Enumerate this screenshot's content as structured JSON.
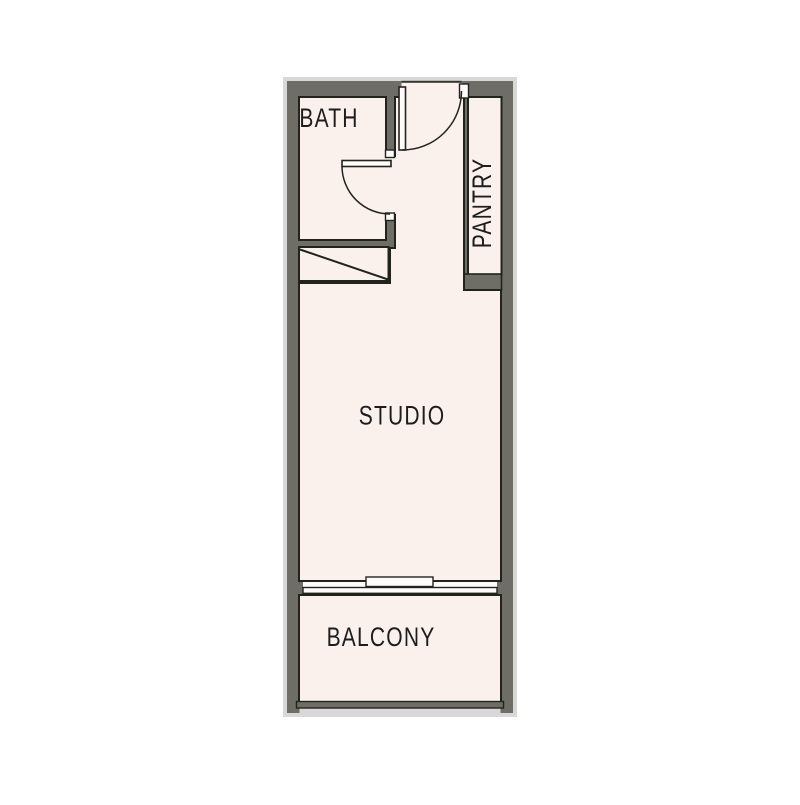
{
  "title": "Studio apartment floor plan",
  "rooms": {
    "bath": {
      "label": "BATH"
    },
    "pantry": {
      "label": "PANTRY"
    },
    "studio": {
      "label": "STUDIO"
    },
    "balcony": {
      "label": "BALCONY"
    }
  },
  "colors": {
    "wall": "#6e6e66",
    "floor": "#faf1ed",
    "outline": "#23231e",
    "halo": "#d8d8d8",
    "door_leaf": "#fefcfb",
    "window_white": "#fefcfb",
    "threshold": "#35352f",
    "label_text": "#1d1d1d",
    "background": "#ffffff"
  }
}
